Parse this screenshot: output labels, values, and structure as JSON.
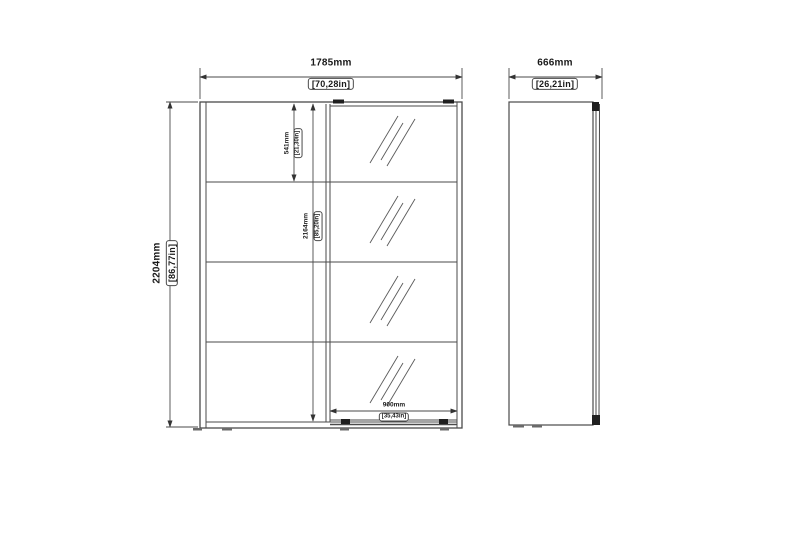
{
  "diagram": {
    "type": "furniture-dimension-drawing",
    "subject": "sliding-door-wardrobe-with-mirror",
    "front_view": {
      "width": {
        "mm": "1785mm",
        "in": "[70,28in]"
      },
      "height": {
        "mm": "2204mm",
        "in": "[86,77in]"
      },
      "top_section": {
        "mm": "541mm",
        "in": "[21,30in]"
      },
      "interior_height": {
        "mm": "2164mm",
        "in": "[85,20in]"
      },
      "mirror_door_width": {
        "mm": "900mm",
        "in": "[35,43in]"
      }
    },
    "side_view": {
      "depth": {
        "mm": "666mm",
        "in": "[26,21in]"
      }
    },
    "colors": {
      "line": "#4a4a4a",
      "dark_detail": "#1f1f1f",
      "text": "#1a1a1a",
      "background": "#ffffff"
    }
  }
}
